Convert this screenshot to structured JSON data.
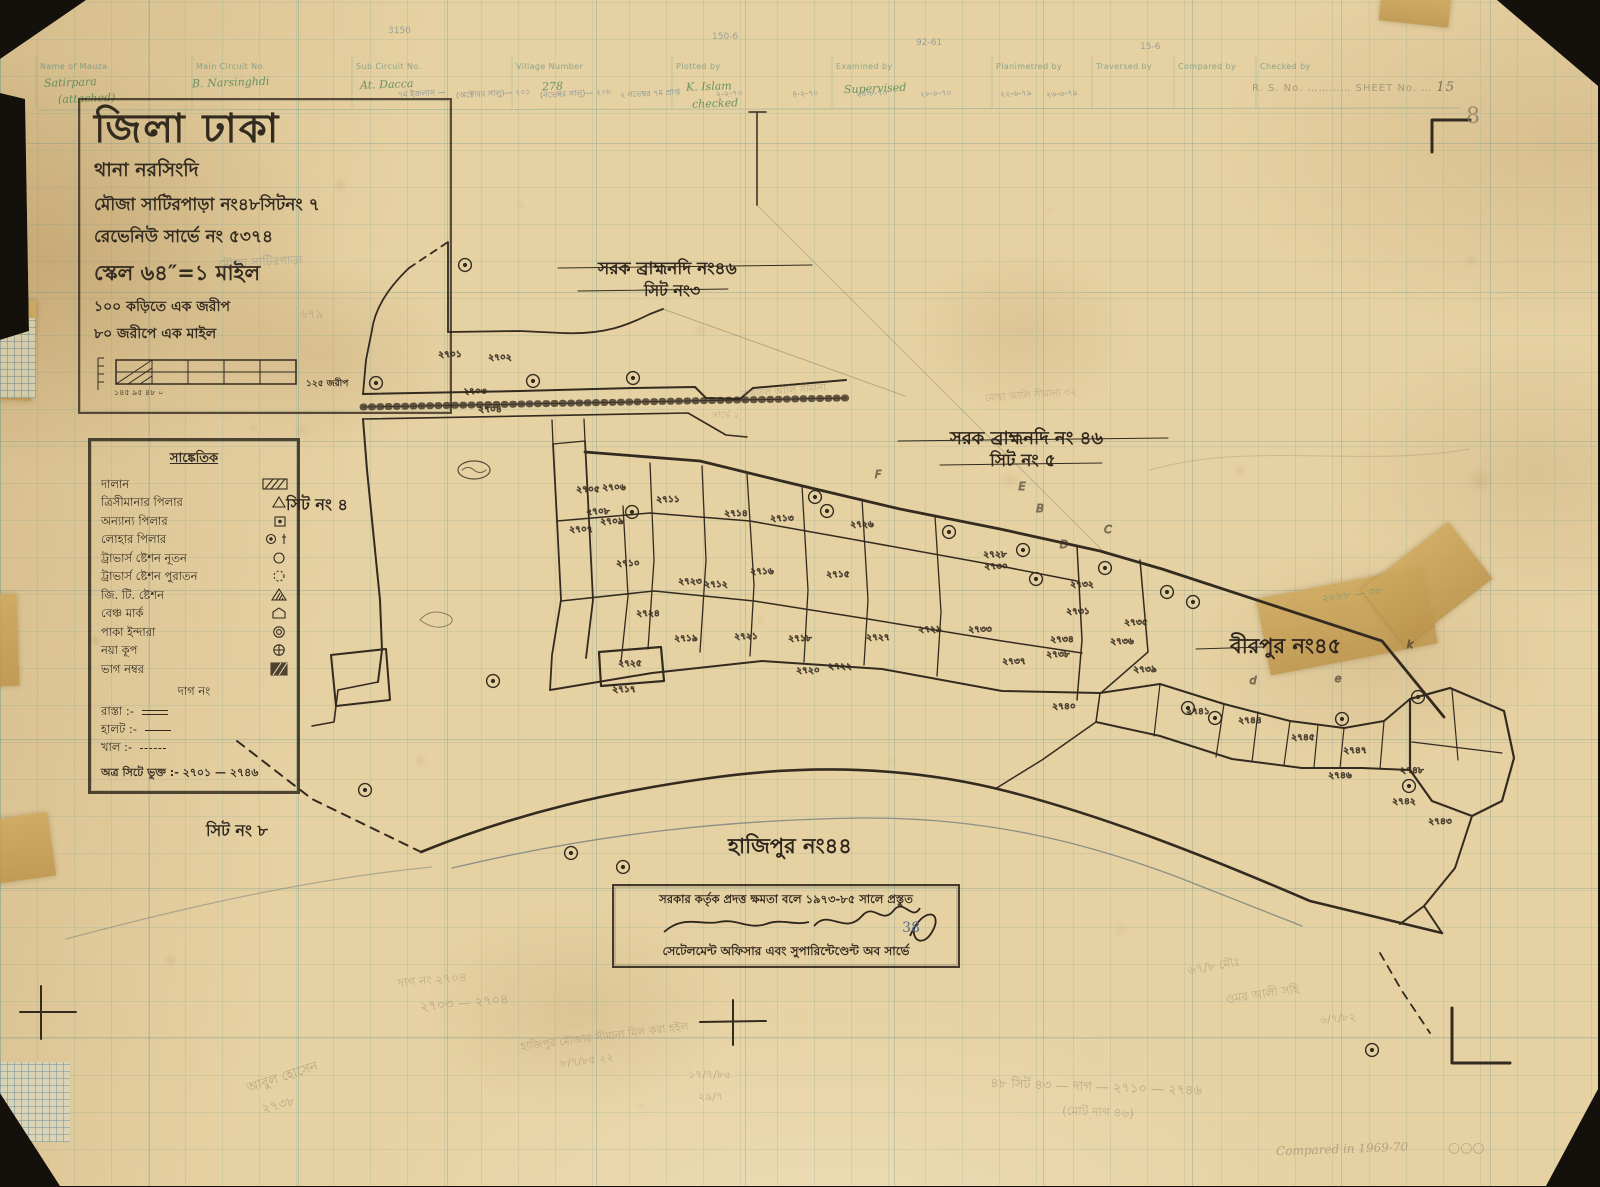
{
  "colors": {
    "paper": "#e6d1a2",
    "ink": "#342b20",
    "grid_teal": "#5f9a91",
    "blue_note": "#4a6f93",
    "green_note": "#3f7d4e",
    "pencil": "#8d7d63",
    "tape": "#c8a055"
  },
  "header_table": {
    "columns": [
      "Name of Mauza",
      "Main Circuit No.",
      "Sub Circuit No.",
      "Village Number",
      "Plotted by",
      "Examined by",
      "Planimetred by",
      "Traversed by",
      "Compared by",
      "Checked by"
    ],
    "col_x": [
      40,
      196,
      356,
      516,
      676,
      836,
      996,
      1096,
      1178,
      1260
    ],
    "entries": [
      {
        "t": "Satirpara",
        "x": 44,
        "y": 76
      },
      {
        "t": "(attached)",
        "x": 58,
        "y": 92
      },
      {
        "t": "B. Narsinghdi",
        "x": 192,
        "y": 76
      },
      {
        "t": "At. Dacca",
        "x": 360,
        "y": 78
      },
      {
        "t": "278",
        "x": 542,
        "y": 80
      },
      {
        "t": "K. Islam",
        "x": 686,
        "y": 80
      },
      {
        "t": "checked",
        "x": 692,
        "y": 97
      },
      {
        "t": "Supervised",
        "x": 844,
        "y": 82
      }
    ],
    "date_stamps": [
      {
        "t": "৭ম ইজলাস —",
        "x": 398
      },
      {
        "t": "(অক্টোবর সালু)— ২০১",
        "x": 456
      },
      {
        "t": "(নভেম্বর সালু)— ২০৮",
        "x": 540
      },
      {
        "t": "২ নভেম্বর ৭ম প্রাপ্ত",
        "x": 620
      },
      {
        "t": "২-২-৭০",
        "x": 716
      },
      {
        "t": "৪-২-৭০",
        "x": 792
      },
      {
        "t": "২৪-৮-৭০",
        "x": 856
      },
      {
        "t": "২৮-৮-৭০",
        "x": 920
      },
      {
        "t": "২২-৬-৭৯",
        "x": 1000
      },
      {
        "t": "২৬-৬-৭৯",
        "x": 1046
      }
    ],
    "faint_numbers": [
      {
        "t": "3150",
        "x": 388,
        "y": 26
      },
      {
        "t": "150-6",
        "x": 712,
        "y": 32
      },
      {
        "t": "92-61",
        "x": 916,
        "y": 38
      },
      {
        "t": "15-6",
        "x": 1140,
        "y": 42
      }
    ],
    "rs_label": "R. S. No.",
    "sheet_label": "SHEET No.",
    "sheet_value": "15",
    "pencil_below": "8"
  },
  "title_block": {
    "district_line": "জিলা ঢাকা",
    "thana_line": "থানা   নরসিংদি",
    "mouza_line": "মৌজা  সাটিরপাড়া নং৪৮সিটনং ৭",
    "revenue_line": "রেভেনিউ সার্ভে নং ৫৩৭৪",
    "scale_line": "স্কেল ৬৪″=১ মাইল",
    "scale_note1": "১০০ কড়িতে এক জরীপ",
    "scale_note2": "৮০ জরীপে এক মাইল",
    "scalebar_labels": "১৪৫  ৯৫  ৪৮  ০",
    "scalebar_right": "১২৫ জরীপ"
  },
  "legend": {
    "title": "সাঙ্কেতিক",
    "items": [
      {
        "label": "দালান",
        "sym": "hatch-rect"
      },
      {
        "label": "ত্রিসীমানার পিলার",
        "sym": "triangle"
      },
      {
        "label": "অন্যান্য পিলার",
        "sym": "square-dot"
      },
      {
        "label": "লোহার পিলার",
        "sym": "circle-dot-dagger"
      },
      {
        "label": "ট্রাভার্স ষ্টেশন নূতন",
        "sym": "circle"
      },
      {
        "label": "ট্রাভার্স ষ্টেশন পুরাতন",
        "sym": "circle-dashed"
      },
      {
        "label": "জি. টি. ষ্টেশন",
        "sym": "triangle-hatched"
      },
      {
        "label": "বেঞ্চ মার্ক",
        "sym": "benchmark"
      },
      {
        "label": "পাকা ইন্দারা",
        "sym": "double-circle"
      },
      {
        "label": "নয়া কূপ",
        "sym": "circle-cross"
      },
      {
        "label": "ভাগ নম্বর",
        "sym": "hatch-block"
      }
    ],
    "center_row": "দাগ নং",
    "extra_rows": [
      {
        "label": "রাস্তা :-",
        "samp": "road"
      },
      {
        "label": "হালট :-",
        "samp": "halot"
      },
      {
        "label": "খাল :-",
        "samp": "khal"
      }
    ],
    "included_line": "অত্র সিটে ভুক্ত :- ২৭০১ — ২৭৪৬"
  },
  "map_labels": [
    {
      "t": "সরক ব্রাহ্মনদি নং৪৬",
      "x": 598,
      "y": 256,
      "s": 17
    },
    {
      "t": "সিট নং৩",
      "x": 644,
      "y": 278,
      "s": 16
    },
    {
      "t": "সরক ব্রাহ্মনদি নং ৪৬",
      "x": 950,
      "y": 424,
      "s": 18
    },
    {
      "t": "সিট নং ৫",
      "x": 990,
      "y": 448,
      "s": 17
    },
    {
      "t": "সিট নং ৪",
      "x": 286,
      "y": 492,
      "s": 16
    },
    {
      "t": "সিট নং ৮",
      "x": 206,
      "y": 818,
      "s": 16
    },
    {
      "t": "হাজিপুর নং৪৪",
      "x": 728,
      "y": 830,
      "s": 21
    },
    {
      "t": "বীরপুর নং৪৫",
      "x": 1230,
      "y": 630,
      "s": 21
    }
  ],
  "stamp": {
    "line1": "সরকার কর্তৃক প্রদত্ত ক্ষমতা বলে ১৯৭৩-৮৫ সালে প্রস্তুত",
    "line3": "সেটেলমেন্ট অফিসার এবং সুপারিন্টেণ্ডেন্ট অব সার্ভে",
    "blue_mark": "38"
  },
  "map": {
    "plot_labels": [
      {
        "t": "২৭০১",
        "x": 450,
        "y": 357
      },
      {
        "t": "২৭০২",
        "x": 500,
        "y": 360
      },
      {
        "t": "২৭০৩",
        "x": 475,
        "y": 394
      },
      {
        "t": "২৭০৪",
        "x": 490,
        "y": 412
      },
      {
        "t": "২৭০৫",
        "x": 588,
        "y": 492
      },
      {
        "t": "২৭০৬",
        "x": 614,
        "y": 490
      },
      {
        "t": "২৭০৭",
        "x": 581,
        "y": 532
      },
      {
        "t": "২৭০৮",
        "x": 598,
        "y": 514
      },
      {
        "t": "২৭০৯",
        "x": 612,
        "y": 524
      },
      {
        "t": "২৭১০",
        "x": 628,
        "y": 566
      },
      {
        "t": "২৭১১",
        "x": 668,
        "y": 502
      },
      {
        "t": "২৭১২",
        "x": 716,
        "y": 587
      },
      {
        "t": "২৭১৩",
        "x": 782,
        "y": 521
      },
      {
        "t": "২৭১৪",
        "x": 736,
        "y": 516
      },
      {
        "t": "২৭১৫",
        "x": 838,
        "y": 577
      },
      {
        "t": "২৭১৬",
        "x": 762,
        "y": 574
      },
      {
        "t": "২৭১৭",
        "x": 624,
        "y": 692
      },
      {
        "t": "২৭১৮",
        "x": 800,
        "y": 641
      },
      {
        "t": "২৭১৯",
        "x": 686,
        "y": 641
      },
      {
        "t": "২৭২০",
        "x": 808,
        "y": 673
      },
      {
        "t": "২৭২১",
        "x": 746,
        "y": 639
      },
      {
        "t": "২৭২২",
        "x": 840,
        "y": 669
      },
      {
        "t": "২৭২৩",
        "x": 690,
        "y": 584
      },
      {
        "t": "২৭২৪",
        "x": 648,
        "y": 616
      },
      {
        "t": "২৭২৫",
        "x": 630,
        "y": 666
      },
      {
        "t": "২৭২৬",
        "x": 862,
        "y": 527
      },
      {
        "t": "২৭২৭",
        "x": 878,
        "y": 640
      },
      {
        "t": "২৭২৮",
        "x": 995,
        "y": 557
      },
      {
        "t": "২৭২৯",
        "x": 930,
        "y": 632
      },
      {
        "t": "২৭৩০",
        "x": 996,
        "y": 569
      },
      {
        "t": "২৭৩১",
        "x": 1078,
        "y": 614
      },
      {
        "t": "২৭৩২",
        "x": 1082,
        "y": 587
      },
      {
        "t": "২৭৩৩",
        "x": 980,
        "y": 632
      },
      {
        "t": "২৭৩৪",
        "x": 1062,
        "y": 642
      },
      {
        "t": "২৭৩৫",
        "x": 1136,
        "y": 625
      },
      {
        "t": "২৭৩৬",
        "x": 1122,
        "y": 644
      },
      {
        "t": "২৭৩৭",
        "x": 1014,
        "y": 664
      },
      {
        "t": "২৭৩৮",
        "x": 1058,
        "y": 657
      },
      {
        "t": "২৭৩৯",
        "x": 1145,
        "y": 672
      },
      {
        "t": "২৭৪০",
        "x": 1064,
        "y": 709
      },
      {
        "t": "২৭৪১",
        "x": 1198,
        "y": 714
      },
      {
        "t": "২৭৪২",
        "x": 1404,
        "y": 804
      },
      {
        "t": "২৭৪৩",
        "x": 1440,
        "y": 824
      },
      {
        "t": "২৭৪৪",
        "x": 1250,
        "y": 723
      },
      {
        "t": "২৭৪৫",
        "x": 1303,
        "y": 740
      },
      {
        "t": "২৭৪৬",
        "x": 1340,
        "y": 778
      },
      {
        "t": "২৭৪৭",
        "x": 1355,
        "y": 753
      },
      {
        "t": "২৭৪৮",
        "x": 1412,
        "y": 773
      }
    ],
    "stations": [
      [
        465,
        265
      ],
      [
        376,
        383
      ],
      [
        533,
        381
      ],
      [
        633,
        378
      ],
      [
        815,
        497
      ],
      [
        827,
        511
      ],
      [
        632,
        512
      ],
      [
        949,
        532
      ],
      [
        1023,
        550
      ],
      [
        1105,
        568
      ],
      [
        1036,
        579
      ],
      [
        1167,
        592
      ],
      [
        1193,
        602
      ],
      [
        1188,
        708
      ],
      [
        1215,
        718
      ],
      [
        1342,
        719
      ],
      [
        1418,
        697
      ],
      [
        1409,
        786
      ],
      [
        365,
        790
      ],
      [
        571,
        853
      ],
      [
        623,
        867
      ],
      [
        493,
        681
      ],
      [
        1372,
        1050
      ]
    ],
    "letters": [
      {
        "t": "F",
        "x": 878,
        "y": 478
      },
      {
        "t": "E",
        "x": 1022,
        "y": 490
      },
      {
        "t": "B",
        "x": 1040,
        "y": 512
      },
      {
        "t": "C",
        "x": 1108,
        "y": 533
      },
      {
        "t": "D",
        "x": 1064,
        "y": 548
      },
      {
        "t": "d",
        "x": 1253,
        "y": 684
      },
      {
        "t": "e",
        "x": 1338,
        "y": 682
      },
      {
        "t": "k",
        "x": 1410,
        "y": 648
      }
    ]
  },
  "notes": [
    {
      "t": "মৌজা সাটিরপাড়া",
      "x": 218,
      "y": 254,
      "r": -3,
      "c": "blue",
      "s": 12,
      "o": 0.35
    },
    {
      "t": "৬৭৯",
      "x": 300,
      "y": 306,
      "r": 0,
      "c": "pencil",
      "s": 12,
      "o": 0.4
    },
    {
      "t": "বায়তুল আলি সীমানা",
      "x": 742,
      "y": 384,
      "r": -5,
      "c": "pencil",
      "s": 10,
      "o": 0.45
    },
    {
      "t": "মোহা আলি সীমানা ৩২",
      "x": 985,
      "y": 388,
      "r": -4,
      "c": "pencil",
      "s": 10,
      "o": 0.4
    },
    {
      "t": "সার্ভে ২",
      "x": 712,
      "y": 408,
      "r": 0,
      "c": "pencil",
      "s": 9,
      "o": 0.4
    },
    {
      "t": "২৮৮৮ — ৩৮",
      "x": 1322,
      "y": 586,
      "r": -8,
      "c": "teal",
      "s": 11,
      "o": 0.5
    },
    {
      "t": "দাগ নং ২৭০৪",
      "x": 398,
      "y": 972,
      "r": -5,
      "c": "pencil",
      "s": 12,
      "o": 0.45
    },
    {
      "t": "২৭০৩ — ২৭০৪",
      "x": 420,
      "y": 994,
      "r": -5,
      "c": "pencil",
      "s": 13,
      "o": 0.5
    },
    {
      "t": "আবুল হোসেন",
      "x": 246,
      "y": 1068,
      "r": -18,
      "c": "pencil",
      "s": 13,
      "o": 0.5
    },
    {
      "t": "২৭৩৮",
      "x": 262,
      "y": 1096,
      "r": -15,
      "c": "pencil",
      "s": 13,
      "o": 0.5
    },
    {
      "t": "হাজিপুর মৌজার সীমানা মিল করা হইল",
      "x": 520,
      "y": 1028,
      "r": -7,
      "c": "pencil",
      "s": 11,
      "o": 0.45
    },
    {
      "t": "৮/৭/৮৫  ২২",
      "x": 560,
      "y": 1052,
      "r": -7,
      "c": "pencil",
      "s": 11,
      "o": 0.45
    },
    {
      "t": "১৭/৭/৮৫",
      "x": 688,
      "y": 1066,
      "r": 0,
      "c": "pencil",
      "s": 11,
      "o": 0.45
    },
    {
      "t": "২৯/৭",
      "x": 698,
      "y": 1088,
      "r": 0,
      "c": "pencil",
      "s": 11,
      "o": 0.45
    },
    {
      "t": "৪৮ সিট ৪৩ — দাগ — ২৭১০ — ২৭৪৬",
      "x": 990,
      "y": 1078,
      "r": 2,
      "c": "pencil",
      "s": 13,
      "o": 0.5
    },
    {
      "t": "(মোট দাগ ৪৬)",
      "x": 1062,
      "y": 1104,
      "r": 2,
      "c": "pencil",
      "s": 12,
      "o": 0.45
    },
    {
      "t": "৬৭/৮ মৌঃ",
      "x": 1188,
      "y": 958,
      "r": -10,
      "c": "pencil",
      "s": 12,
      "o": 0.45
    },
    {
      "t": "ওমর আলী সহি",
      "x": 1226,
      "y": 986,
      "r": -8,
      "c": "pencil",
      "s": 12,
      "o": 0.45
    },
    {
      "t": "৬/৭/৮২",
      "x": 1320,
      "y": 1010,
      "r": -5,
      "c": "pencil",
      "s": 11,
      "o": 0.45
    },
    {
      "t": "Compared in 1969-70",
      "x": 1276,
      "y": 1142,
      "r": -2,
      "c": "pencil",
      "s": 12,
      "o": 0.55,
      "f": 1
    },
    {
      "t": "○○○",
      "x": 1448,
      "y": 1140,
      "r": 0,
      "c": "pencil",
      "s": 14,
      "o": 0.5
    }
  ]
}
